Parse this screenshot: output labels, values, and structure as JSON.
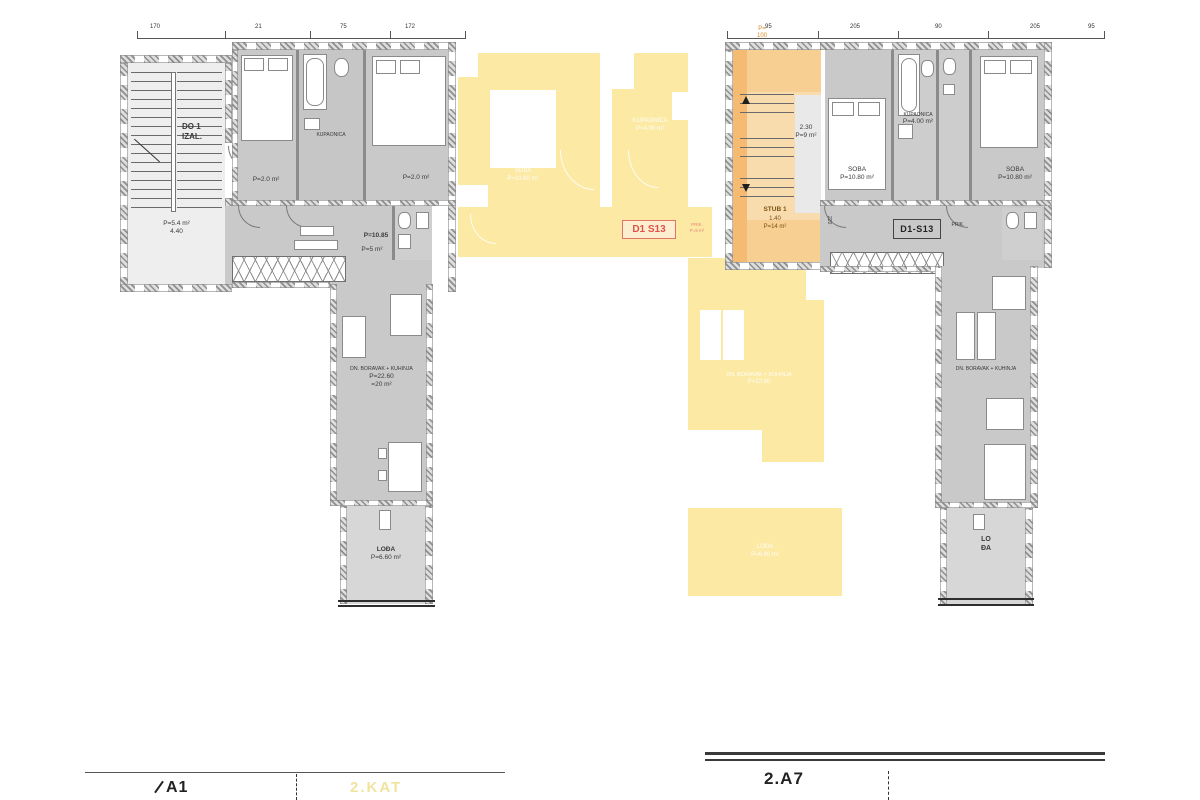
{
  "drawing": {
    "type": "floor-plan",
    "sheet": "apartment level plan, two units"
  },
  "colors": {
    "room_fill": "#c9c9c9",
    "light_fill": "#e9e9e9",
    "highlight_yellow": "#fbe9a4",
    "highlight_orange": "#f7c178",
    "label_red": "#e0504a",
    "wall_line": "#555555"
  },
  "left_plan": {
    "stair_exit": [
      "DO 1",
      "IZAL."
    ],
    "stair_room": [
      "P=5.4 m²",
      "4.40"
    ],
    "closet_left": "P=2.0 m²",
    "closet_right": "P=2.0 m²",
    "bath_label": "KUPAONICA",
    "hall": [
      "P=10.85",
      "P=5 m²"
    ],
    "living": [
      "DN. BORAVAK + KUHINJA",
      "P=22.60",
      "=20 m²"
    ],
    "loggia": [
      "LOĐA",
      "P=6.60 m²"
    ],
    "dims_top": [
      "170",
      "21",
      "75",
      "172"
    ]
  },
  "common_yellow": {
    "room_a": [
      "SOBA",
      "P=10.80 m²"
    ],
    "room_b": [
      "KUPAONICA",
      "P=4.00 m²"
    ],
    "corridor_code": "D1 S13",
    "corridor_tiny": [
      "PRIK.",
      "P=9 m²"
    ],
    "wing": [
      "DN. BORAVAK + KUHINJA",
      "P=22.60"
    ],
    "terrace": [
      "LOĐA",
      "P=6.60 m²"
    ]
  },
  "right_plan": {
    "stair_top": [
      "P=",
      "100"
    ],
    "stair_mid": [
      "2.30",
      "P=9 m²"
    ],
    "stair_main": [
      "STUB 1",
      "1.40",
      "P=14 m²"
    ],
    "bath": [
      "KUPAONICA",
      "P=4.00 m²"
    ],
    "bedroom_left": [
      "SOBA",
      "P=10.80 m²"
    ],
    "bedroom_right": [
      "SOBA",
      "P=10.80 m²"
    ],
    "corridor_code": "D1-S13",
    "corridor_tiny": "PRIK.",
    "dim_vertical": "220",
    "living": "DN. BORAVAK + KUHINJA",
    "loggia": [
      "LO",
      "ĐA"
    ],
    "dims_top": [
      "95",
      "205",
      "90",
      "205",
      "95"
    ]
  },
  "footer": {
    "left_title": "A1",
    "left_watermark": "2.KAT",
    "right_title": "2.A7"
  }
}
